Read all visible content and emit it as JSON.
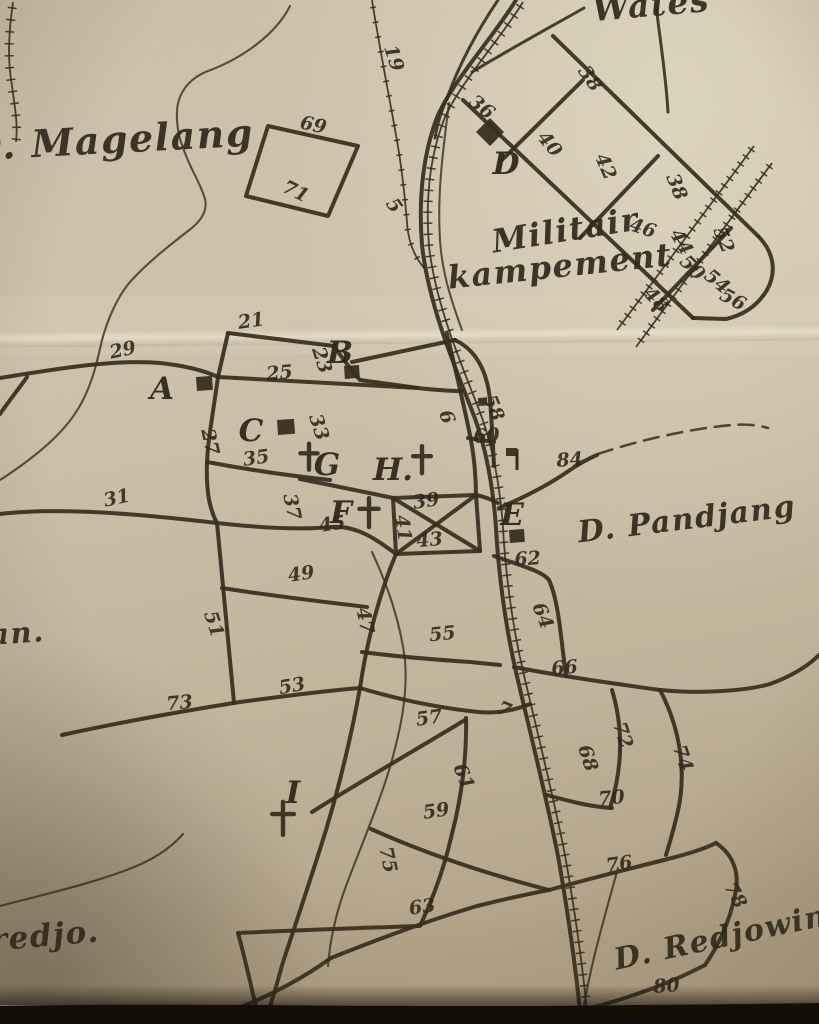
{
  "map": {
    "region_labels": [
      {
        "text": "D. Magelang",
        "x": 112,
        "y": 153,
        "size": 38,
        "rot": -3
      },
      {
        "text": "Wates",
        "x": 652,
        "y": 16,
        "size": 33,
        "rot": -5
      },
      {
        "text": "Militair",
        "x": 567,
        "y": 241,
        "size": 32,
        "rot": -9
      },
      {
        "text": "kampement",
        "x": 561,
        "y": 277,
        "size": 32,
        "rot": -6
      },
      {
        "text": "D. Pandjang",
        "x": 688,
        "y": 529,
        "size": 30,
        "rot": -7
      },
      {
        "text": "D. Redjowina",
        "x": 733,
        "y": 945,
        "size": 30,
        "rot": -12
      },
      {
        "text": "redjo.",
        "x": 46,
        "y": 946,
        "size": 31,
        "rot": -5
      },
      {
        "text": "an.",
        "x": 18,
        "y": 643,
        "size": 29,
        "rot": -4
      }
    ],
    "letters": [
      {
        "t": "A",
        "x": 162,
        "y": 399
      },
      {
        "t": "B",
        "x": 340,
        "y": 363
      },
      {
        "t": "C",
        "x": 251,
        "y": 441
      },
      {
        "t": "D",
        "x": 506,
        "y": 174
      },
      {
        "t": "E",
        "x": 512,
        "y": 525
      },
      {
        "t": "F",
        "x": 341,
        "y": 523
      },
      {
        "t": "G",
        "x": 327,
        "y": 475
      },
      {
        "t": "H.",
        "x": 393,
        "y": 480
      },
      {
        "t": "I",
        "x": 293,
        "y": 803
      }
    ],
    "numbers": [
      {
        "t": "19",
        "x": 388,
        "y": 60,
        "r": 72
      },
      {
        "t": "69",
        "x": 312,
        "y": 131,
        "r": 12
      },
      {
        "t": "71",
        "x": 293,
        "y": 197,
        "r": 26
      },
      {
        "t": "5",
        "x": 389,
        "y": 209,
        "r": 55
      },
      {
        "t": "36",
        "x": 478,
        "y": 112,
        "r": 38
      },
      {
        "t": "38",
        "x": 585,
        "y": 82,
        "r": 55
      },
      {
        "t": "40",
        "x": 545,
        "y": 148,
        "r": 50
      },
      {
        "t": "42",
        "x": 600,
        "y": 169,
        "r": 66
      },
      {
        "t": "38",
        "x": 671,
        "y": 189,
        "r": 68
      },
      {
        "t": "46",
        "x": 641,
        "y": 234,
        "r": 18
      },
      {
        "t": "44",
        "x": 676,
        "y": 245,
        "r": 60
      },
      {
        "t": "52",
        "x": 718,
        "y": 242,
        "r": 68
      },
      {
        "t": "50",
        "x": 688,
        "y": 272,
        "r": 45
      },
      {
        "t": "54",
        "x": 713,
        "y": 286,
        "r": 40
      },
      {
        "t": "48",
        "x": 652,
        "y": 304,
        "r": 45
      },
      {
        "t": "56",
        "x": 730,
        "y": 305,
        "r": 28
      },
      {
        "t": "21",
        "x": 252,
        "y": 327,
        "r": -8
      },
      {
        "t": "29",
        "x": 124,
        "y": 356,
        "r": -12
      },
      {
        "t": "23",
        "x": 316,
        "y": 362,
        "r": 72
      },
      {
        "t": "25",
        "x": 280,
        "y": 379,
        "r": -5
      },
      {
        "t": "27",
        "x": 204,
        "y": 443,
        "r": 78
      },
      {
        "t": "33",
        "x": 313,
        "y": 429,
        "r": 72
      },
      {
        "t": "35",
        "x": 257,
        "y": 464,
        "r": -8
      },
      {
        "t": "6",
        "x": 441,
        "y": 419,
        "r": 70
      },
      {
        "t": "58",
        "x": 488,
        "y": 410,
        "r": 68
      },
      {
        "t": "60",
        "x": 487,
        "y": 442,
        "r": -5
      },
      {
        "t": "84",
        "x": 570,
        "y": 466,
        "r": -4
      },
      {
        "t": "31",
        "x": 118,
        "y": 504,
        "r": -12
      },
      {
        "t": "37",
        "x": 286,
        "y": 508,
        "r": 78
      },
      {
        "t": "39",
        "x": 427,
        "y": 507,
        "r": -8
      },
      {
        "t": "41",
        "x": 397,
        "y": 529,
        "r": 82
      },
      {
        "t": "45",
        "x": 333,
        "y": 530,
        "r": -8
      },
      {
        "t": "43",
        "x": 430,
        "y": 546,
        "r": -5
      },
      {
        "t": "62",
        "x": 528,
        "y": 565,
        "r": -4
      },
      {
        "t": "49",
        "x": 302,
        "y": 580,
        "r": -8
      },
      {
        "t": "64",
        "x": 537,
        "y": 618,
        "r": 68
      },
      {
        "t": "51",
        "x": 208,
        "y": 626,
        "r": 72
      },
      {
        "t": "47",
        "x": 359,
        "y": 622,
        "r": 78
      },
      {
        "t": "55",
        "x": 443,
        "y": 640,
        "r": -6
      },
      {
        "t": "66",
        "x": 565,
        "y": 674,
        "r": -5
      },
      {
        "t": "53",
        "x": 293,
        "y": 692,
        "r": -10
      },
      {
        "t": "73",
        "x": 180,
        "y": 709,
        "r": -5
      },
      {
        "t": "7",
        "x": 502,
        "y": 715,
        "r": 22
      },
      {
        "t": "57",
        "x": 430,
        "y": 724,
        "r": -8
      },
      {
        "t": "72",
        "x": 617,
        "y": 737,
        "r": 72
      },
      {
        "t": "68",
        "x": 582,
        "y": 760,
        "r": 72
      },
      {
        "t": "74",
        "x": 677,
        "y": 760,
        "r": 72
      },
      {
        "t": "61",
        "x": 458,
        "y": 779,
        "r": 68
      },
      {
        "t": "70",
        "x": 612,
        "y": 804,
        "r": -5
      },
      {
        "t": "59",
        "x": 437,
        "y": 817,
        "r": -8
      },
      {
        "t": "75",
        "x": 382,
        "y": 861,
        "r": 78
      },
      {
        "t": "76",
        "x": 620,
        "y": 870,
        "r": -8
      },
      {
        "t": "78",
        "x": 730,
        "y": 898,
        "r": 62
      },
      {
        "t": "63",
        "x": 423,
        "y": 913,
        "r": -8
      },
      {
        "t": "80",
        "x": 667,
        "y": 992,
        "r": -5
      }
    ],
    "squares": [
      {
        "x": 196,
        "y": 377,
        "w": 16,
        "h": 14,
        "name": "building-square-a"
      },
      {
        "x": 344,
        "y": 366,
        "w": 15,
        "h": 13,
        "name": "building-square-b"
      },
      {
        "x": 277,
        "y": 420,
        "w": 17,
        "h": 15,
        "name": "building-square-c"
      },
      {
        "x": 509,
        "y": 530,
        "w": 15,
        "h": 13,
        "name": "building-square-e"
      },
      {
        "x": 478,
        "y": 398,
        "w": 9,
        "h": 8,
        "name": "building-square-58"
      }
    ],
    "diamond": {
      "x": 490,
      "y": 132,
      "r": 14,
      "name": "building-diamond-d"
    },
    "crosses": [
      {
        "x": 309,
        "y": 458,
        "s": 26,
        "name": "church-cross-g"
      },
      {
        "x": 422,
        "y": 461,
        "s": 27,
        "name": "church-cross-h"
      },
      {
        "x": 369,
        "y": 514,
        "s": 29,
        "name": "church-cross-f"
      },
      {
        "x": 283,
        "y": 820,
        "s": 33,
        "name": "church-cross-i"
      }
    ],
    "flag": {
      "px": 517,
      "py1": 449,
      "py2": 470,
      "rx": 506,
      "ry": 448,
      "rw": 11,
      "rh": 8,
      "name": "flag-building"
    }
  },
  "colors": {
    "paper": "#cbc0a9",
    "paper_light": "#e9e0ca",
    "paper_dark": "#b09f85",
    "ink": "#2e2617",
    "ink_text": "#271f12",
    "photo_edge": "#140e08"
  }
}
